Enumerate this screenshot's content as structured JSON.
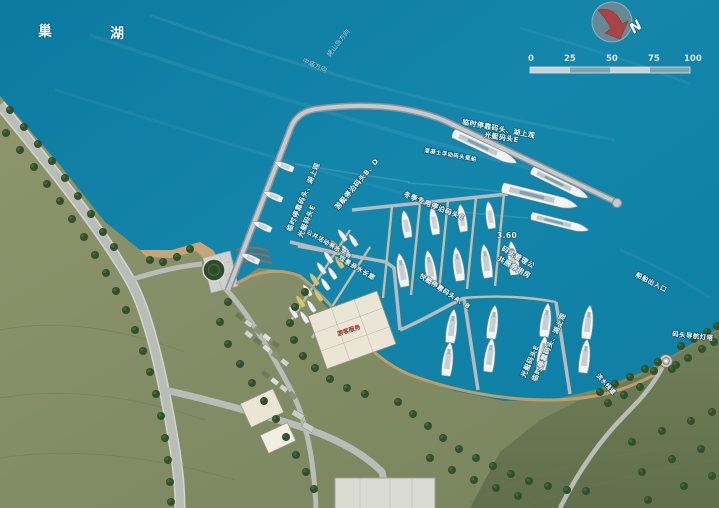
{
  "title": {
    "left": "巢",
    "right": "湖"
  },
  "compass": {
    "label": "N"
  },
  "scale_bar": {
    "ticks": [
      "0",
      "25",
      "50",
      "75",
      "100"
    ]
  },
  "water": {
    "direction_laoshan": "姥山岛方向",
    "direction_zhongmiao": "中庙方向",
    "elevation_mark": "3.60",
    "vessel_entrance": "船舶出入口"
  },
  "piers": {
    "temp_dock_line1": "临时停靠码头、湖上观",
    "temp_dock_line2": "光艇码头E",
    "pontoon": "混凝土浮动码头趸船",
    "yacht_berth_bd": "游艇停泊码头B、D",
    "winter_berth_c": "冬季专用停泊码头C",
    "speedboat_ab": "快艇停靠码头A、B",
    "management_line1": "码头管理公",
    "management_line2": "共服务用房"
  },
  "shore": {
    "public_platform": "公共活动亲水平台",
    "corridor": "观景亲水长廊",
    "lighthouse": "码头导航灯塔",
    "boardwalk": "滨水栈道",
    "visitor_center": "游客服务"
  },
  "colors": {
    "water": "#0f81a6",
    "land_light": "#8a9169",
    "land_dark": "#70805a",
    "pier": "#b7bbbd",
    "sand": "#c9a678",
    "tree": "#30502b",
    "building": "#ebe5d5",
    "compass_red": "#a84444",
    "label_red": "#8b3125"
  }
}
